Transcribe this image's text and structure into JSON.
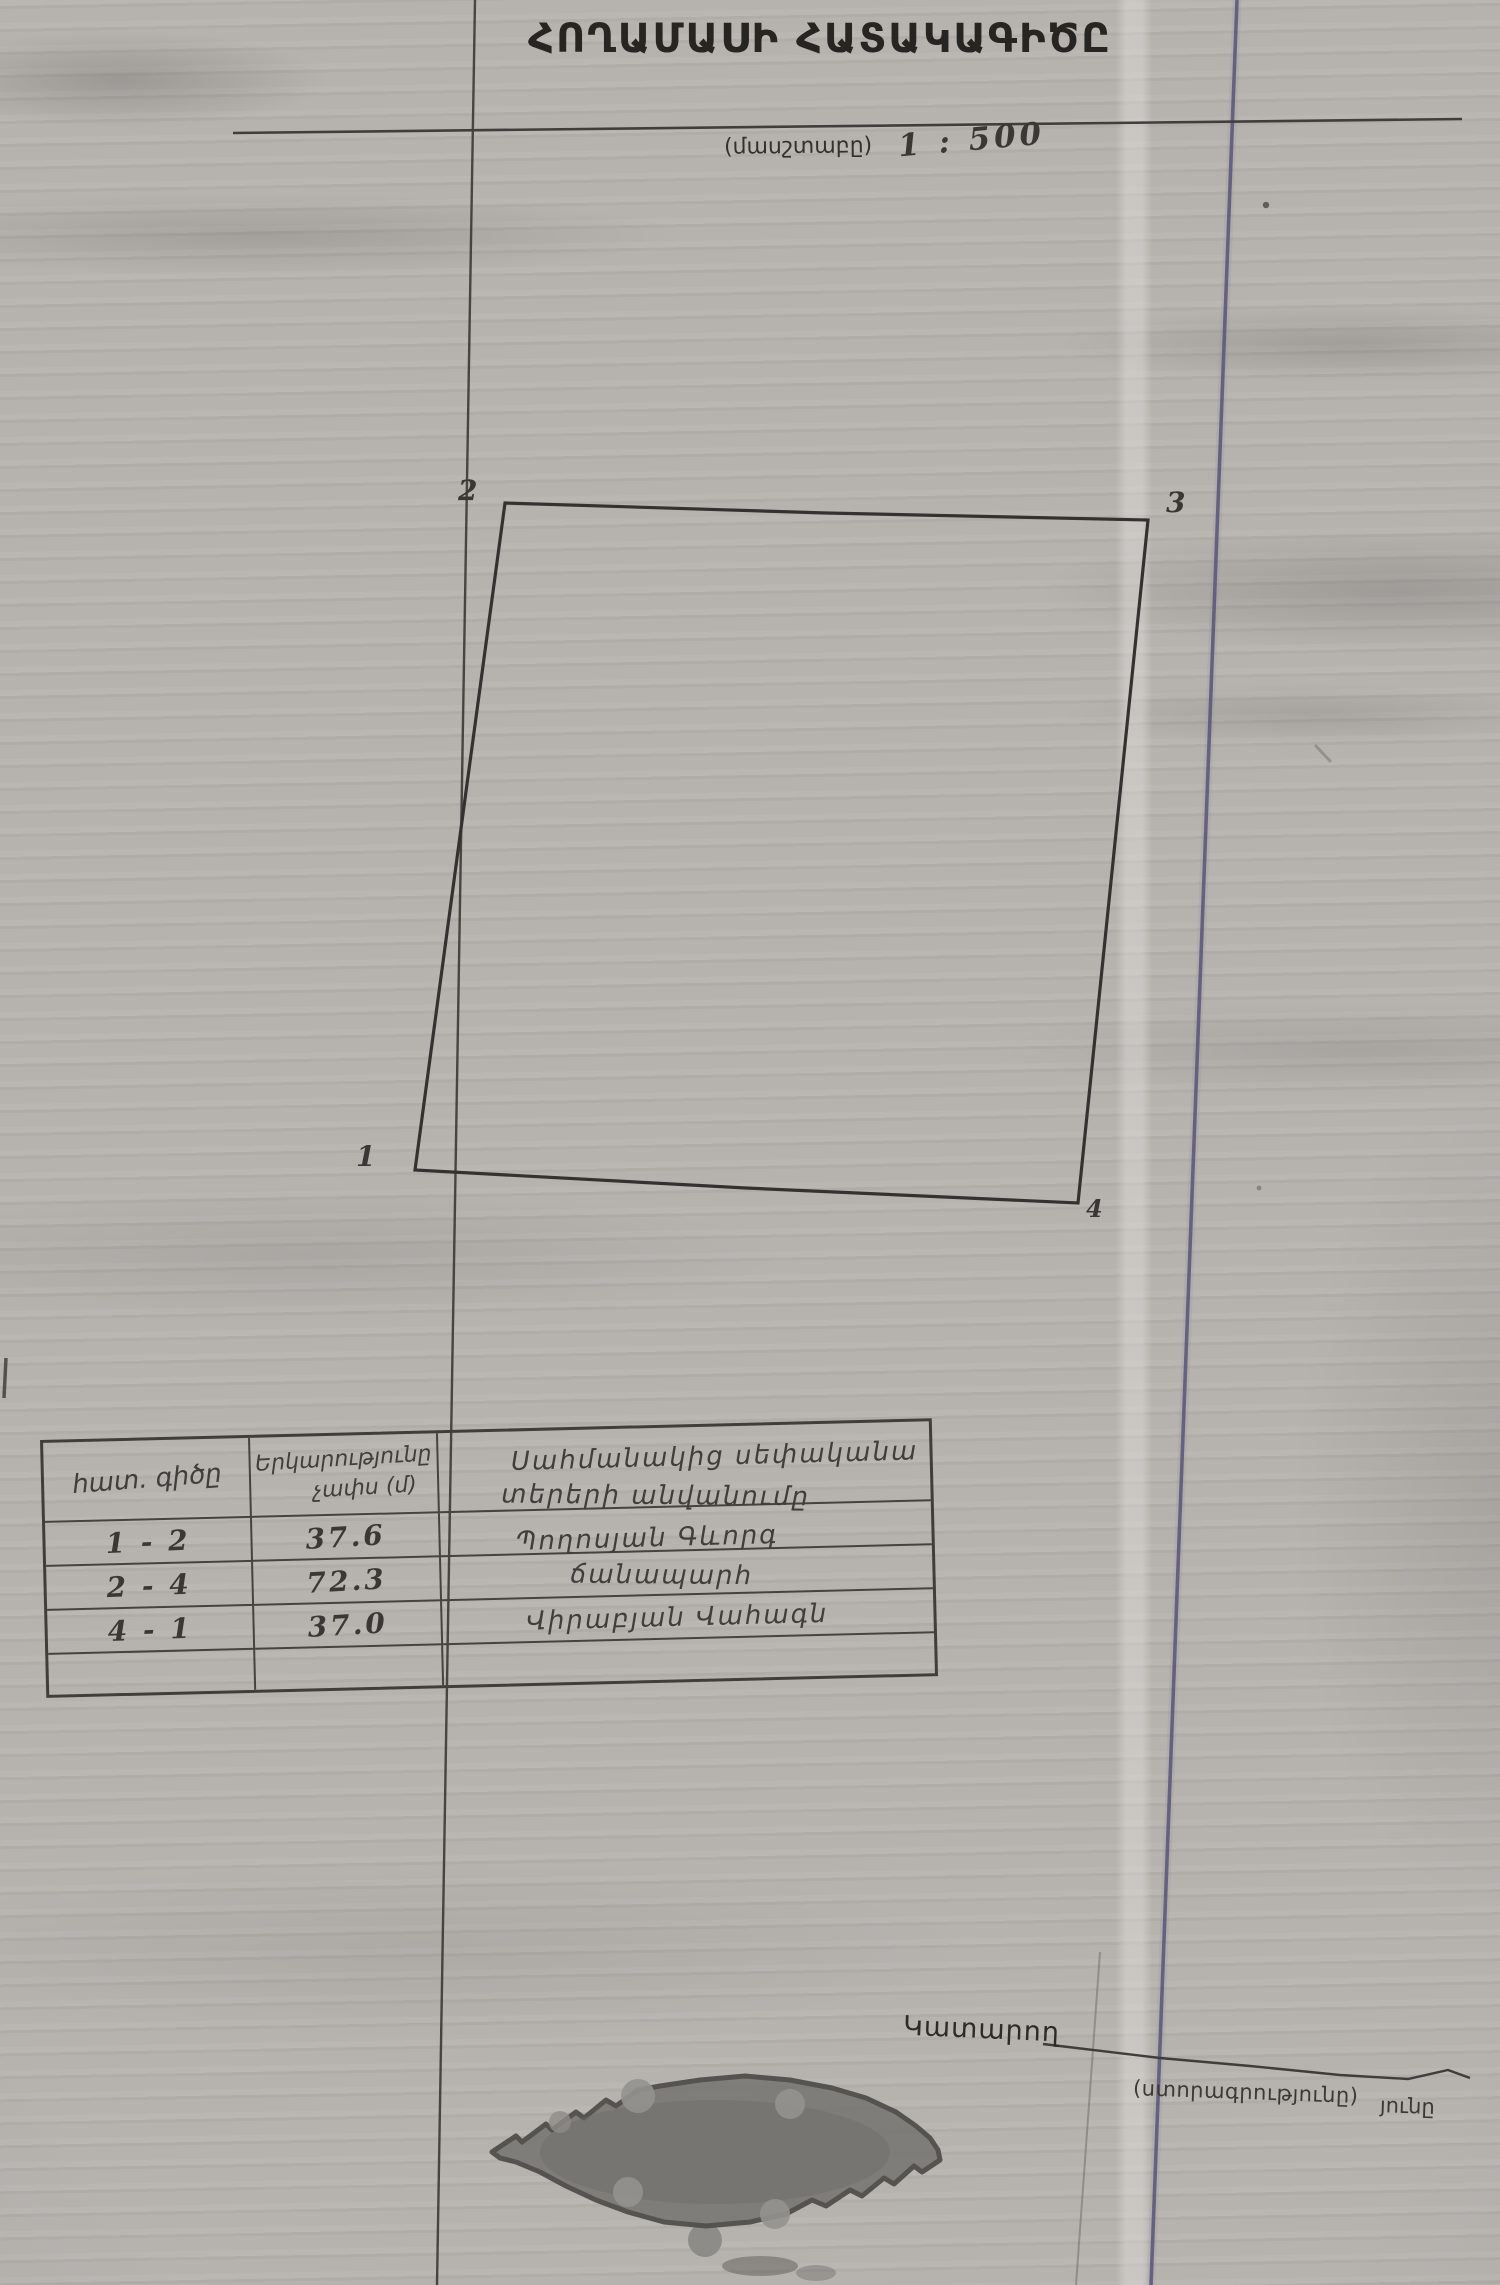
{
  "document": {
    "title": "ՀՈՂԱՄԱՍԻ ՀԱՏԱԿԱԳԻԾԸ",
    "scale_label": "(մասշտաբը)",
    "scale_value": "1 : 500"
  },
  "plot": {
    "vertices": [
      {
        "label": "1"
      },
      {
        "label": "2"
      },
      {
        "label": "3"
      },
      {
        "label": "4"
      }
    ]
  },
  "table": {
    "headers": {
      "col1": "հատ. գիծը",
      "col2_line1": "Երկարությունը",
      "col2_line2": "չափս (մ)"
    },
    "rows": [
      {
        "segment": "1 - 2",
        "length": "37.6"
      },
      {
        "segment": "2 - 4",
        "length": "72.3"
      },
      {
        "segment": "4 - 1",
        "length": "37.0"
      }
    ],
    "neighbors": {
      "line1": "Սահմանակից սեփականա",
      "line2": "տերերի անվանումը",
      "line3": "Պողոսյան Գևորգ",
      "line4": "ճանապարհ",
      "line5": "Վիրաբյան Վահագն"
    }
  },
  "footer": {
    "executor_label": "Կատարող",
    "signature_caption": "(ստորագրությունը)",
    "caption_fragment": "յունը"
  },
  "colors": {
    "paper": "#b6b3af",
    "ink": "#2e2c29",
    "ruled_line_black": "#3b3936",
    "ruled_line_blue": "#5b5877",
    "stamp_fill": "#7d7b77"
  }
}
